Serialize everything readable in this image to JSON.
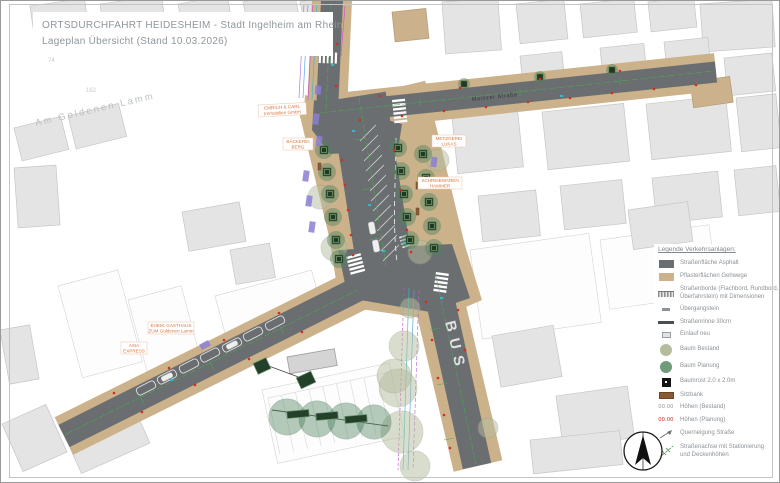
{
  "sheet": {
    "title_line1": "ORTSDURCHFAHRT HEIDESHEIM - Stadt Ingelheim am Rhein",
    "title_line2": "Lageplan Übersicht (Stand 10.03.2026)"
  },
  "map": {
    "streets": {
      "mainzer": "Mainzer Straße",
      "am_goldenen_lamm": "Am Goldenen Lamm"
    },
    "road_marking_bus": "BUS",
    "parcels": {
      "n74": "74",
      "n2": "2",
      "n3": "3",
      "n162": "162"
    },
    "businesses": {
      "emrich": {
        "line1": "EMRICH & CARL",
        "line2": "Immobilien GmbH"
      },
      "baeckerei": {
        "line1": "BÄCKEREI",
        "line2": "BERG"
      },
      "metzgerei": {
        "line1": "METZGEREI",
        "line2": "LUKAS"
      },
      "schreibwaren": {
        "line1": "SCHREIBWAREN",
        "line2": "HAMMER"
      },
      "gasthaus": {
        "line1": "EHEM. GASTHAUS",
        "line2": "ZUM Goldenen Lamm"
      },
      "asia": {
        "line1": "ASIA",
        "line2": "EXPRESS"
      }
    }
  },
  "legend": {
    "title": "Legende Verkehrsanlagen:",
    "items": [
      {
        "id": "asphalt",
        "label": "Straßenfläche Asphalt"
      },
      {
        "id": "paving",
        "label": "Pflasterflächen Gehwege"
      },
      {
        "id": "curb",
        "label": "Straßenborde (Flachbord, Rundbord,",
        "label2": "Überfahrstein) mit Dimensionen"
      },
      {
        "id": "transition-stone",
        "label": "Übergangstein"
      },
      {
        "id": "gutter",
        "label": "Straßenrinne 30cm"
      },
      {
        "id": "inlet",
        "label": "Einlauf neu"
      },
      {
        "id": "tree-existing",
        "label": "Baum Bestand"
      },
      {
        "id": "tree-planned",
        "label": "Baum Planung"
      },
      {
        "id": "tree-grate",
        "label": "Baumrost 2.0 x 2.0m"
      },
      {
        "id": "bench",
        "label": "Sitzbank"
      },
      {
        "id": "heights-existing",
        "label": "Höhen (Bestand)",
        "sample": "00.00"
      },
      {
        "id": "heights-planned",
        "label": "Höhen (Planung)",
        "sample": "00.00"
      },
      {
        "id": "cross-slope",
        "label": "Querneigung Straße"
      },
      {
        "id": "axis",
        "label": "Straßenachse mit Stationierung",
        "label2": "und Deckenhöhen"
      }
    ]
  },
  "colors": {
    "asphalt": "#6b6e70",
    "paving": "#ccb28a",
    "tree_existing": "#b5bc9e",
    "tree_planned": "#6f9b79",
    "business_label": "#d9763f",
    "heights_existing": "#8d9296",
    "heights_planned": "#cc2222",
    "axis_green": "#46b050"
  }
}
